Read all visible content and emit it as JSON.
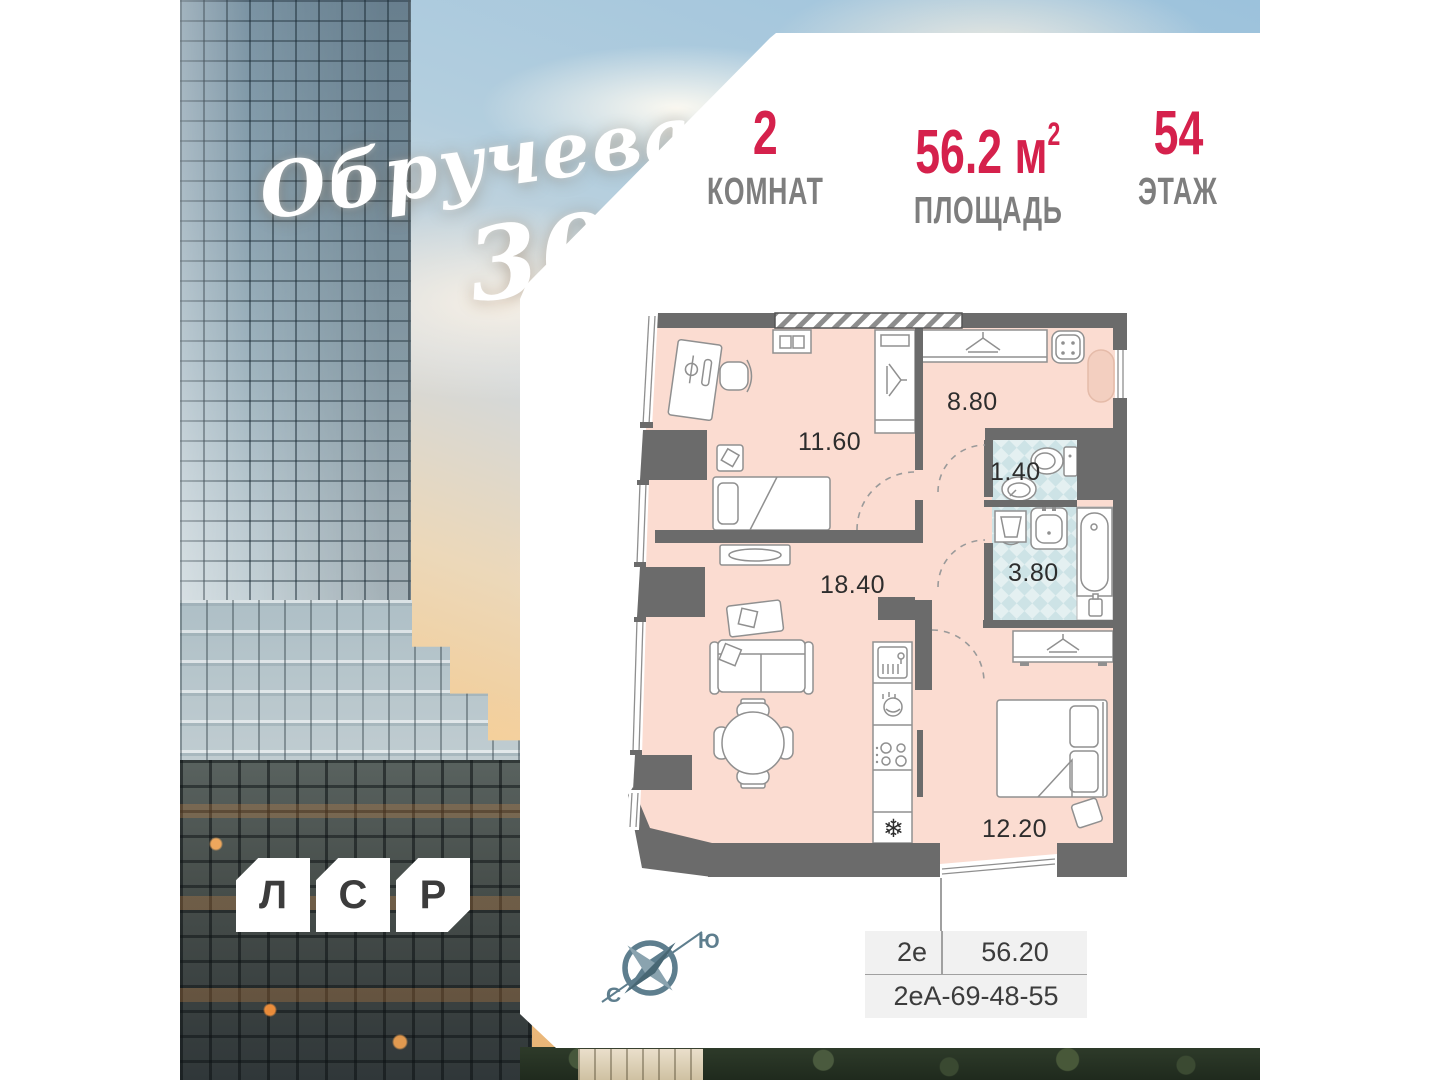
{
  "logo": {
    "line1": "Обручева",
    "line2": "30"
  },
  "stats": {
    "rooms": {
      "value": "2",
      "label": "КОМНАТ"
    },
    "area": {
      "value": "56.2",
      "unit": "м",
      "unit_sup": "2",
      "label": "ПЛОЩАДЬ"
    },
    "floor": {
      "value": "54",
      "label": "ЭТАЖ"
    }
  },
  "plan": {
    "rooms": [
      {
        "id": "bedroom-1",
        "area": "11.60"
      },
      {
        "id": "hallway",
        "area": "8.80"
      },
      {
        "id": "wc",
        "area": "1.40"
      },
      {
        "id": "bathroom",
        "area": "3.80"
      },
      {
        "id": "living-kitchen",
        "area": "18.40"
      },
      {
        "id": "bedroom-2",
        "area": "12.20"
      }
    ],
    "icons": {
      "snowflake": "❄"
    }
  },
  "compass": {
    "south_label": "Ю",
    "north_label": "С"
  },
  "unit_table": {
    "type": "2е",
    "area": "56.20",
    "code": "2еА-69-48-55"
  },
  "brand": {
    "letters": [
      "Л",
      "С",
      "Р"
    ]
  },
  "colors": {
    "accent_red": "#d5214c",
    "label_gray": "#7e7e7e",
    "wall_gray": "#6b6b6b",
    "floor_pink": "#fbdcd1",
    "tile_blue": "#cde3e6",
    "compass_slate": "#5e7e8e",
    "table_bg": "#f1f1f1"
  }
}
